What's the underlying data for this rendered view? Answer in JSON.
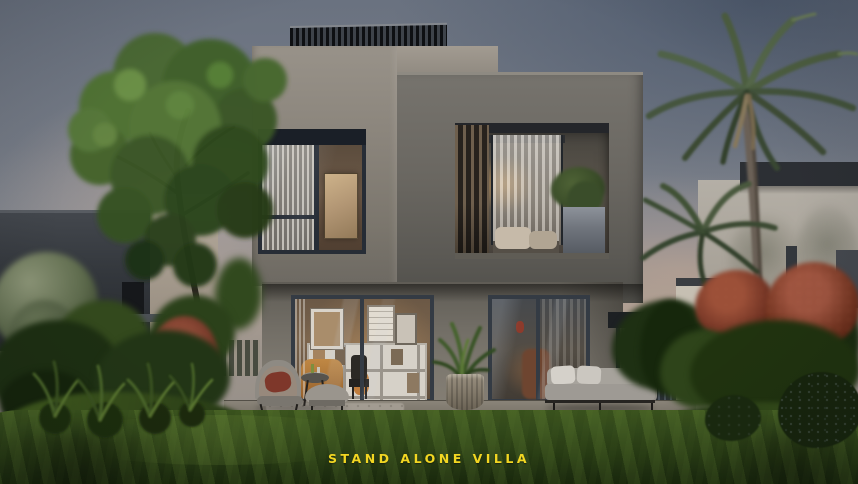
{
  "scene": {
    "caption": "STAND ALONE VILLA",
    "description": "Dusk exterior rendering of a modern two-storey grey concrete stand-alone villa with warm lit interiors, a front lawn, garden shrubs and red flowering bushes, a large tree on the left and palm trees beside a pale neighbouring villa on the right."
  },
  "palette": {
    "caption_yellow": "#F2D622",
    "sky_top": "#6A7280",
    "sky_horizon_warm": "#A89C92",
    "concrete_light": "#8F8A81",
    "concrete_dark": "#64625D",
    "window_frame": "#343B44",
    "interior_warm_glow": "#C08A4E",
    "lawn_green": "#2F4518",
    "foliage_green": "#3F5C28",
    "flower_red": "#8C4936"
  }
}
